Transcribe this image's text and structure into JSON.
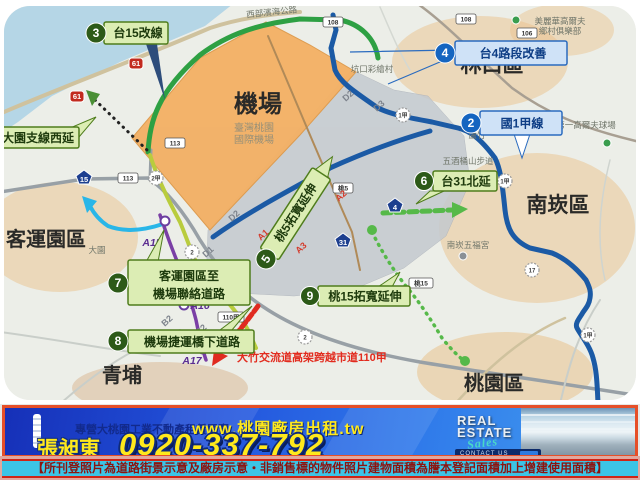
{
  "map": {
    "region_labels": {
      "airport": "機場",
      "airport_sub1": "臺灣桃園",
      "airport_sub2": "國際機場",
      "linkou": "林口區",
      "nankan": "南崁區",
      "taoyuan": "桃園區",
      "qingpu": "青埔",
      "keyun": "客運園區"
    },
    "places": {
      "golf1a": "美麗華高爾夫",
      "golf1b": "鄉村俱樂部",
      "golf2": "第一高爾夫球場",
      "wujiutong": "五酒桶山步道",
      "wufugong": "南崁五福宮",
      "kengkou": "坑口彩繪村",
      "dayuan": "大園",
      "luzhu": "蘆竹",
      "coast": "西部濱海公路"
    },
    "callouts": {
      "c3": {
        "num": "3",
        "label": "台15改線"
      },
      "c4": {
        "num": "4",
        "label": "台4路段改善"
      },
      "c2": {
        "num": "2",
        "label": "國1甲線"
      },
      "c6": {
        "num": "6",
        "label": "台31北延"
      },
      "c5": {
        "num": "5",
        "label": "桃5拓寬延伸"
      },
      "c9": {
        "num": "9",
        "label": "桃15拓寬延伸"
      },
      "c7": {
        "num": "7",
        "label1": "客運園區至",
        "label2": "機場聯絡道路"
      },
      "c8": {
        "num": "8",
        "label": "機場捷運橋下道路"
      },
      "side": {
        "label": "大園支線西延"
      }
    },
    "red_note": "大竹交流道高架跨越市道110甲",
    "shields": {
      "s113a": "113",
      "s113b": "113",
      "s110": "110",
      "s110j": "110甲",
      "s108a": "108",
      "s108b": "108",
      "s108c": "108",
      "s106": "106",
      "tao5": "桃5",
      "tao15": "桃15",
      "t15": "15",
      "t31": "31",
      "t4": "4",
      "t61a": "61",
      "t61b": "61",
      "f2a": "2",
      "f2b": "2",
      "f2j": "2甲",
      "f1ja": "1甲",
      "f1jb": "1甲",
      "f1jc": "1甲",
      "f17": "17"
    },
    "stations": {
      "a15": "A15",
      "a16": "A16",
      "a17": "A17"
    },
    "segments": {
      "d1": "D1",
      "d2a": "D2",
      "d2b": "D2",
      "d3": "D3",
      "b1": "B1",
      "b2": "B2",
      "c1": "C1",
      "c2": "C2",
      "a1": "A1",
      "a2": "A2",
      "a3": "A3"
    },
    "colors": {
      "callout_green": "#2d5a18",
      "callout_blue": "#1565c0",
      "route_blue": "#1b5aa5",
      "route_green": "#2ea043",
      "metro_purple": "#7a3fa5",
      "airport_orange": "#f3b166"
    }
  },
  "banner": {
    "tagline": "專營大桃園工業不動產租賃買賣",
    "website": "www.桃園廠房出租.tw",
    "name": "張昶東",
    "phone": "0920-337-792",
    "re1": "REAL",
    "re2": "ESTATE",
    "re3": "Sales",
    "contact": "CONTACT US"
  },
  "disclaimer": "【所刊登照片為道路街景示意及廠房示意‧非銷售標的物件照片建物面積為謄本登記面積加上增建使用面積】"
}
